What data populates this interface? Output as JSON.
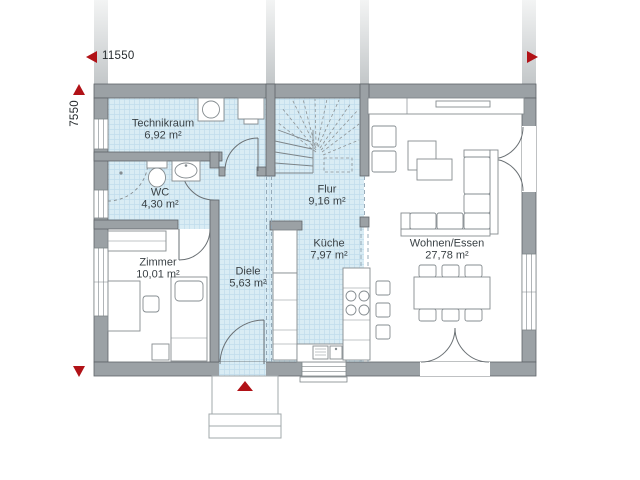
{
  "plan": {
    "dimension_width": "11550",
    "dimension_height": "7550",
    "rooms": [
      {
        "name": "Technikraum",
        "area": "6,92 m²"
      },
      {
        "name": "WC",
        "area": "4,30 m²"
      },
      {
        "name": "Zimmer",
        "area": "10,01 m²"
      },
      {
        "name": "Diele",
        "area": "5,63 m²"
      },
      {
        "name": "Flur",
        "area": "9,16 m²"
      },
      {
        "name": "Küche",
        "area": "7,97 m²"
      },
      {
        "name": "Wohnen/Essen",
        "area": "27,78 m²"
      }
    ]
  },
  "colors": {
    "accent_red": "#b11217",
    "wall_gray": "#9ba1a5",
    "wall_edge": "#5f6569",
    "floor_tile": "#d9ecf4",
    "tile_line": "#c0dcec",
    "furniture_line": "#858c90",
    "text": "#3a4145"
  }
}
